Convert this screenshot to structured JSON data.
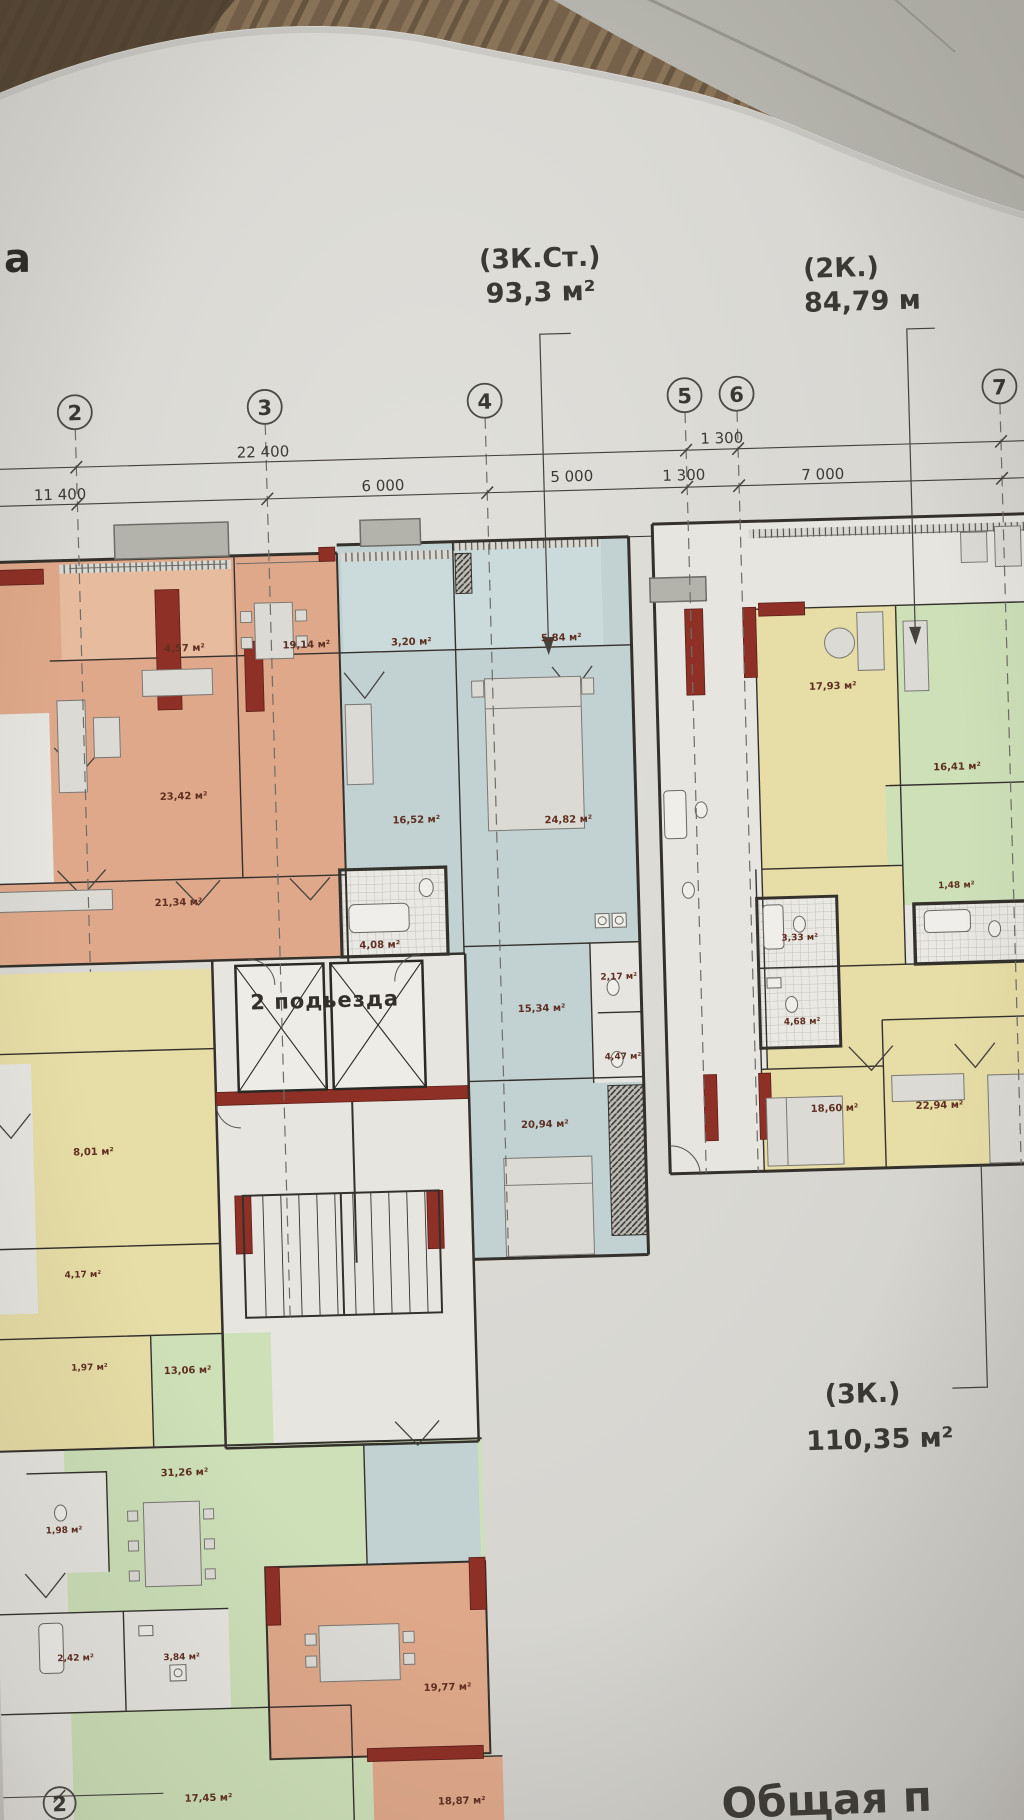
{
  "title_labels": {
    "corner_letter": "а",
    "apt_top": {
      "type": "(3К.Ст.)",
      "area": "93,3 м²"
    },
    "apt_right": {
      "type": "(2К.)",
      "area": "84,79 м"
    },
    "apt_bottom": {
      "type": "(3К.)",
      "area": "110,35 м²"
    },
    "bottom_edge_text": "Общая п"
  },
  "entrance_label": "2 подьезда",
  "axis_numbers": {
    "a2": "2",
    "a3": "3",
    "a4": "4",
    "a5": "5",
    "a6": "6",
    "a7": "7",
    "a2_bottom": "2"
  },
  "dimensions": {
    "overall": "22 400",
    "left_overall": "11 400",
    "span_3_4": "6 000",
    "span_4_5": "5 000",
    "gap_5_6_top": "1 300",
    "gap_5_6": "1 300",
    "span_6_7": "7 000"
  },
  "areas": {
    "k457": "4,57 м²",
    "k1914": "19,14 м²",
    "k320": "3,20 м²",
    "k584": "5,84 м²",
    "k2342": "23,42 м²",
    "k1652": "16,52 м²",
    "k2482": "24,82 м²",
    "k2134": "21,34 м²",
    "k408": "4,08 м²",
    "k217": "2,17 м²",
    "k1534": "15,34 м²",
    "k447": "4,47 м²",
    "k2094": "20,94 м²",
    "k1793": "17,93 м²",
    "k1641": "16,41 м²",
    "k148": "1,48 м²",
    "k333": "3,33 м²",
    "k468": "4,68 м²",
    "k1860": "18,60 м²",
    "k2294": "22,94 м²",
    "k801": "8,01 м²",
    "k417": "4,17 м²",
    "k197": "1,97 м²",
    "k1306": "13,06 м²",
    "k3126": "31,26 м²",
    "k198": "1,98 м²",
    "k242": "2,42 м²",
    "k384": "3,84 м²",
    "k1977": "19,77 м²",
    "k1745": "17,45 м²",
    "k1887": "18,87 м²"
  },
  "colors": {
    "wall_red": "#8e3026",
    "room_orange": "#dfa88a",
    "room_orange_light": "#e7bb9e",
    "room_blue": "#c2d2d2",
    "room_blue_light": "#cbdada",
    "room_yellow": "#e7dda6",
    "room_green": "#cde0b8",
    "room_white": "#e6e5e0",
    "paper": "#d9d8d3",
    "label_ink": "#5f2f21",
    "line_ink": "#45423e"
  }
}
